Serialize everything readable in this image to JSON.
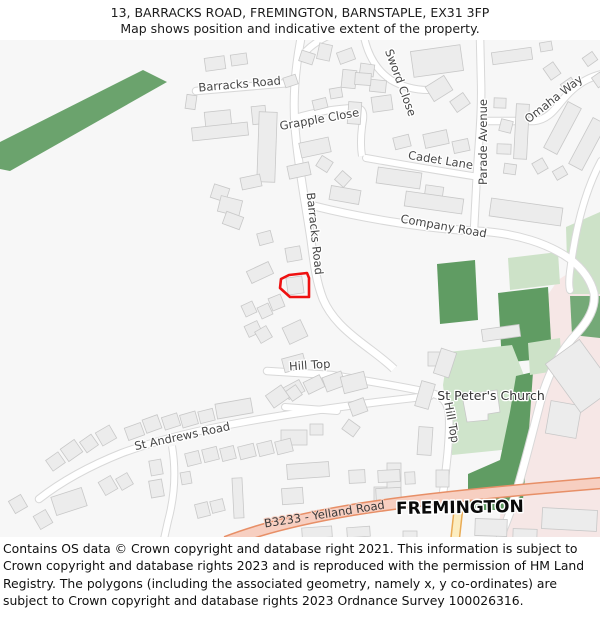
{
  "header": {
    "title": "13, BARRACKS ROAD, FREMINGTON, BARNSTAPLE, EX31 3FP",
    "subtitle": "Map shows position and indicative extent of the property."
  },
  "map": {
    "labels": {
      "barracks_road_top": "Barracks Road",
      "sword_close": "Sword Close",
      "grapple_close": "Grapple Close",
      "cadet_lane": "Cadet Lane",
      "parade_avenue": "Parade Avenue",
      "omaha_way": "Omaha Way",
      "company_road": "Company Road",
      "barracks_road_mid": "Barracks Road",
      "hill_top": "Hill Top",
      "hill_top_vertical": "Hill Top",
      "st_peters_church": "St Peter's Church",
      "st_andrews_road": "St Andrews Road",
      "b3233_yelland_road": "B3233 - Yelland Road",
      "fremington": "FREMINGTON"
    },
    "colors": {
      "property_outline": "#ee1111",
      "map_background": "#f7f7f7",
      "building_fill": "#ececec",
      "building_stroke": "#c8c8c8",
      "road_fill": "#ffffff",
      "road_casing": "#d8d8d8",
      "green_dark": "#609c63",
      "green_band": "#6ba36d",
      "green_light": "#cde2c8",
      "churchyard_green": "#cfe4cb",
      "builtup_pink": "#f6e7e6",
      "b_road_fill": "#f7cfc1",
      "b_road_casing": "#e78f67",
      "minor_road_fill": "#fcedc0",
      "minor_road_casing": "#e9ab55"
    }
  },
  "footer": {
    "text": "Contains OS data © Crown copyright and database right 2021. This information is subject to Crown copyright and database rights 2023 and is reproduced with the permission of HM Land Registry. The polygons (including the associated geometry, namely x, y co-ordinates) are subject to Crown copyright and database rights 2023 Ordnance Survey 100026316."
  }
}
